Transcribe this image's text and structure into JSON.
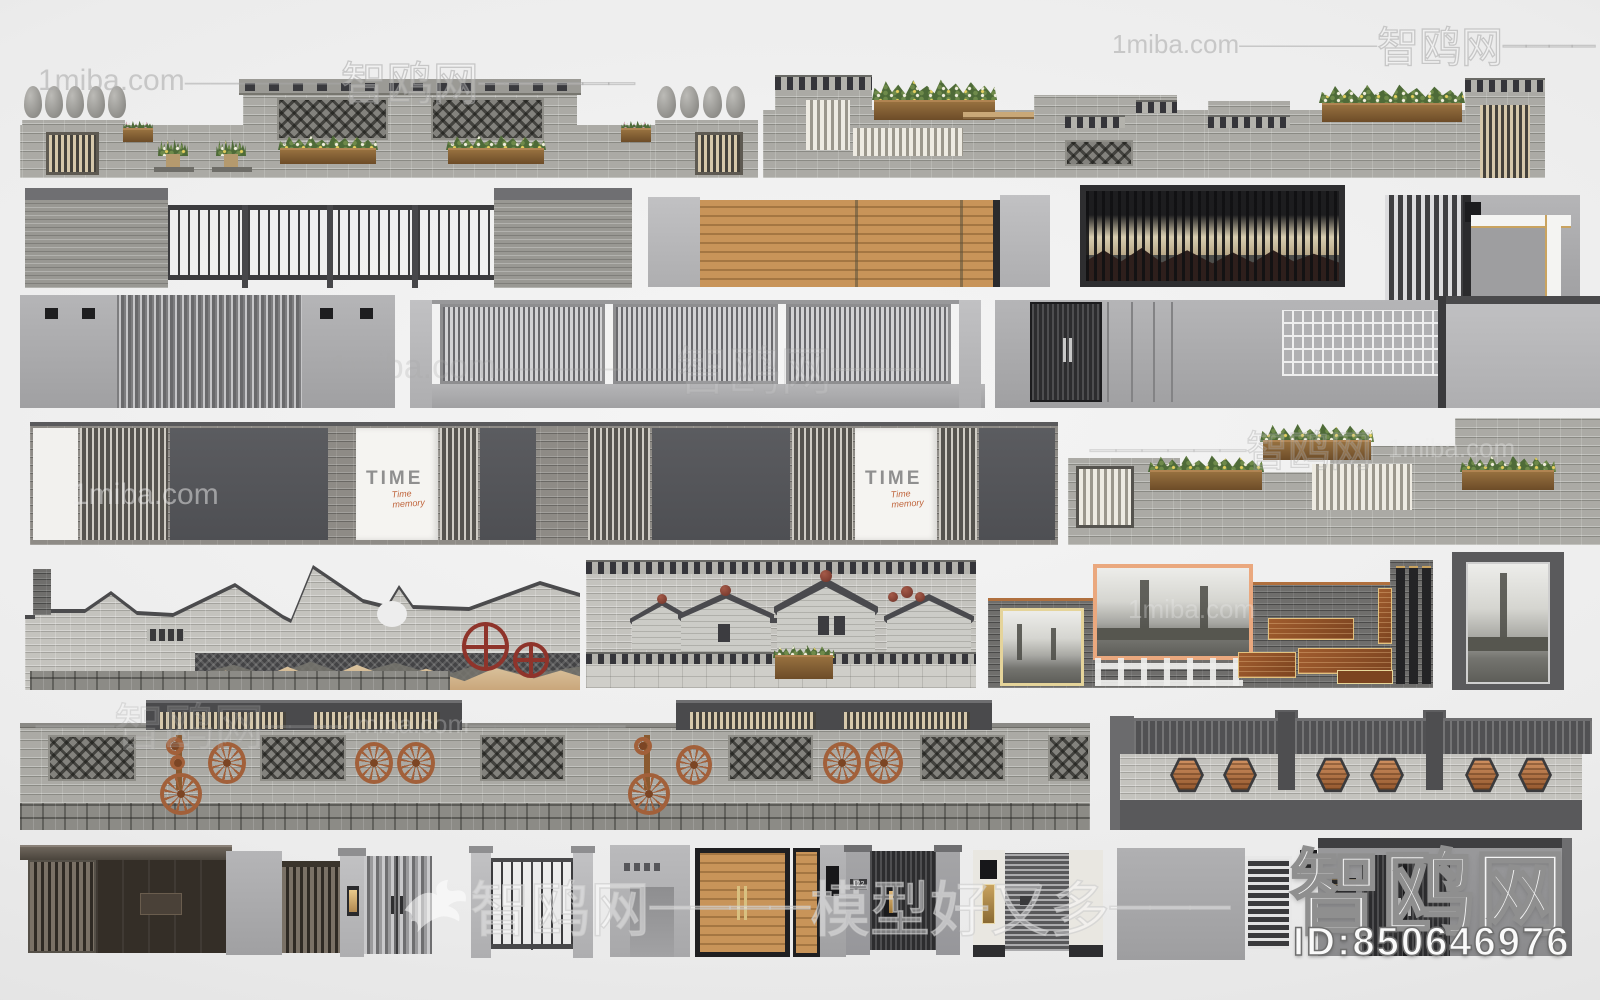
{
  "meta": {
    "type": "3d-model-preview-collage",
    "subject": "Chinese courtyard walls, fences and entrance gate 3D models",
    "canvas_width": 1600,
    "canvas_height": 1000,
    "background_color": "#ececec"
  },
  "watermark": {
    "site_en": "1miba.com",
    "site_cn": "智鸥网",
    "tagline_cn": "模型好又多",
    "dash_long": "——————",
    "dash_mid": "————",
    "dash_short": "———",
    "model_id": "ID:850646976"
  },
  "signs": {
    "time_panel": {
      "title": "TIME",
      "subtitle": "Time memory"
    },
    "house_number": "122"
  },
  "icons": {
    "bird_logo": "dove-silhouette"
  },
  "palette": {
    "brick_light": "#abaaa5",
    "brick_pale": "#c4c3be",
    "brick_dark": "#6f6e6c",
    "frame_dark": "#3f4042",
    "concrete": "#aaaaac",
    "wood_tan": "#cbb28c",
    "copper": "#a2603a",
    "rust_red": "#8f342b",
    "planter_wood": "#7d5a36",
    "foliage_green": "#4e6b38",
    "photo_frame_orange": "#eaa87e",
    "photo_frame_yellow": "#e5d49a"
  },
  "models": [
    "brick wall with pots and planters",
    "brick wall with flower boxes",
    "stone piers with metal fence",
    "wood slat fence with concrete piers",
    "mountain art screen wall",
    "modern slat gate wall",
    "concrete wall with fin gate",
    "bar fence on low wall",
    "concrete wall with dark door and breeze blocks",
    "TIME sign panel wall",
    "stepped brick planter wall",
    "roofline silhouette wall",
    "village relief wall",
    "industrial photo culture wall",
    "brick wall with wagon wheels and lattices",
    "hexagon medallion wall",
    "nine entrance gates"
  ]
}
